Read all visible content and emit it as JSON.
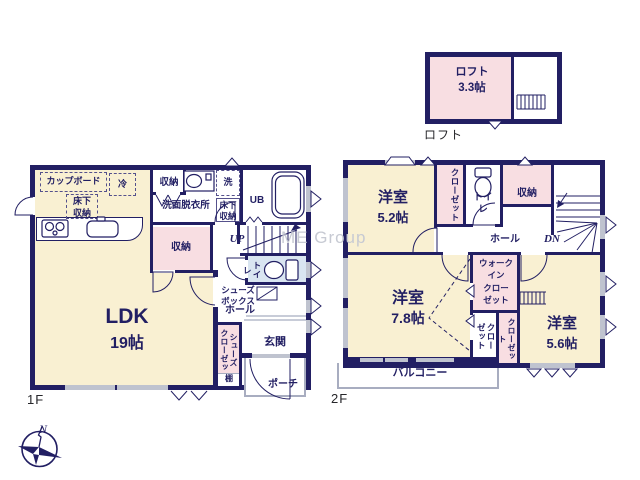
{
  "watermark": "ME Group",
  "compass": {
    "north_label": "N"
  },
  "loft": {
    "plan_label": "ロフト",
    "room": "ロフト",
    "size": "3.3帖"
  },
  "f1": {
    "plan_label": "1F",
    "ldk": "LDK",
    "ldk_size": "19帖",
    "cupboard": "カップボード",
    "fridge": "冷",
    "underfloor_kitchen": "床下\n収納",
    "storage_top": "収納",
    "washroom": "洗面脱衣所",
    "washer": "洗",
    "underfloor_wash": "床下\n収納",
    "bath": "UB",
    "storage_mid": "収納",
    "stairs": "UP",
    "toilet": "トイレ",
    "shoebox": "シューズ\nボックス",
    "hall": "ホール",
    "shoe_closet": "シューズ\nクローゼット",
    "shelf": "棚",
    "entrance": "玄関",
    "porch": "ポーチ"
  },
  "f2": {
    "plan_label": "2F",
    "bedroom1": "洋室",
    "bedroom1_size": "5.2帖",
    "closet1": "クローゼット",
    "toilet": "トイレ",
    "storage": "収納",
    "hall": "ホール",
    "stairs": "DN",
    "bedroom2": "洋室",
    "bedroom2_size": "7.8帖",
    "wic": "ウォーク\nイン\nクロー\nゼット",
    "closet2": "クロー\nゼット",
    "closet3": "クローゼット",
    "bedroom3": "洋室",
    "bedroom3_size": "5.6帖",
    "balcony": "バルコニー"
  },
  "colors": {
    "wall_navy": "#221f63",
    "room_cream": "#f9f0d2",
    "room_pink": "#f8dee2",
    "toilet_blue": "#d9e5f1",
    "outline_gray": "#a8adc0",
    "window_gray": "#bfc3cf",
    "watermark_gray": "#c7cad3"
  }
}
